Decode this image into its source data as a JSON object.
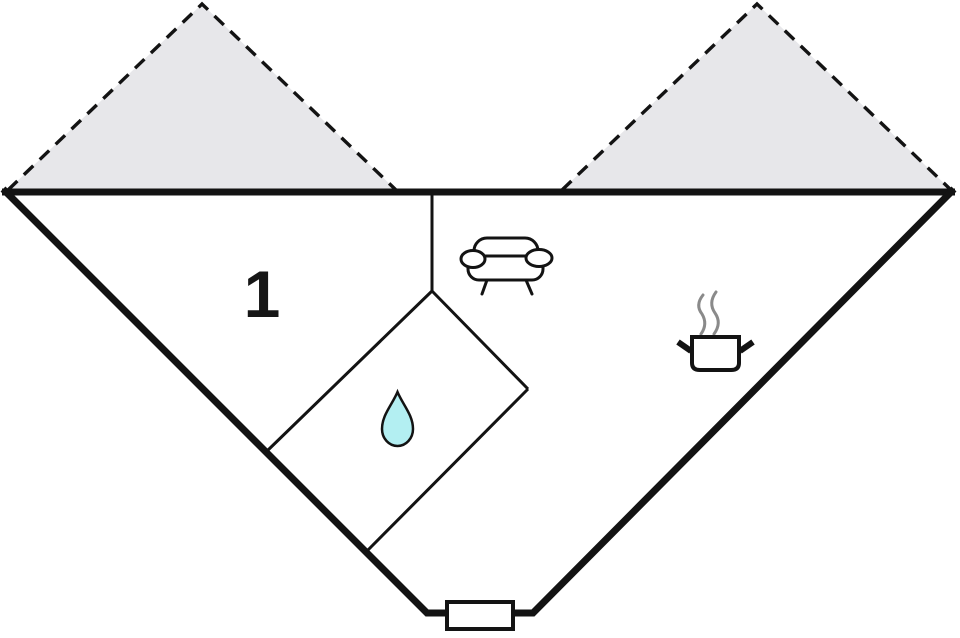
{
  "floorplan": {
    "room_label": "1",
    "colors": {
      "wall": "#131313",
      "roof_fill": "#e7e7ea",
      "water_drop": "#b3eff2",
      "steam": "#8a8a8a",
      "floor": "#ffffff"
    },
    "icons": [
      "roof-overhang-dashed-left",
      "roof-overhang-dashed-right",
      "sofa-icon",
      "water-drop-icon",
      "cooking-pot-icon",
      "entrance-door"
    ]
  }
}
